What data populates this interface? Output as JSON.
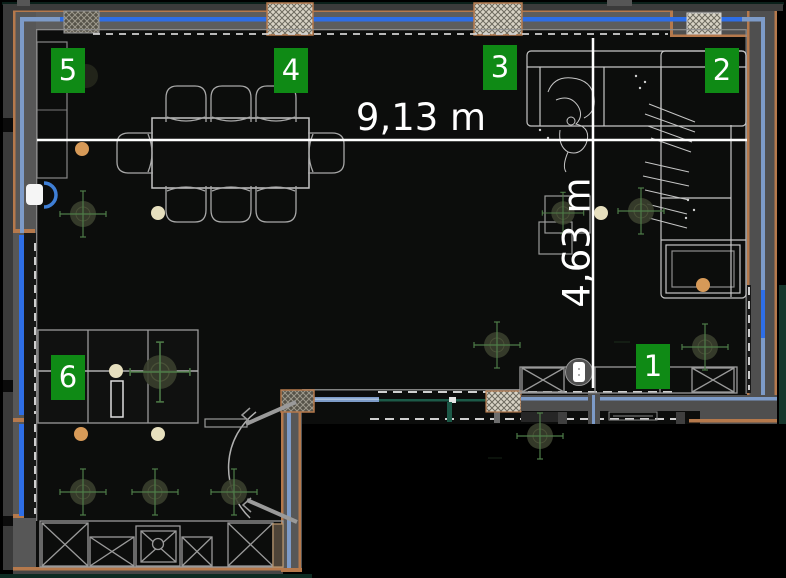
{
  "floorplan": {
    "dimension_labels": {
      "width": "9,13 m",
      "depth": "4,63 m"
    },
    "markers": [
      {
        "label": "1"
      },
      {
        "label": "2"
      },
      {
        "label": "3"
      },
      {
        "label": "4"
      },
      {
        "label": "5"
      },
      {
        "label": "6"
      }
    ],
    "icons": [
      "door-sensor-icon",
      "smart-plug-icon",
      "ceiling-light-icon",
      "spotlight-crosshair-icon"
    ],
    "colors": {
      "marker_green": "#0f8a15",
      "dimension_white": "#ffffff",
      "glazing_blue": "#2e6ee6",
      "wall_steel_blue": "#7d9bc8",
      "wall_gray": "#575757",
      "wall_outer_gray": "#3b3b3b",
      "accent_orange": "#b5794c",
      "partition_teal": "#1c5a48",
      "floor_black": "#0c0d0c",
      "furniture_line": "#c6c6c6",
      "light_warm": "#d79a58",
      "light_cool": "#e6dfbe"
    }
  }
}
